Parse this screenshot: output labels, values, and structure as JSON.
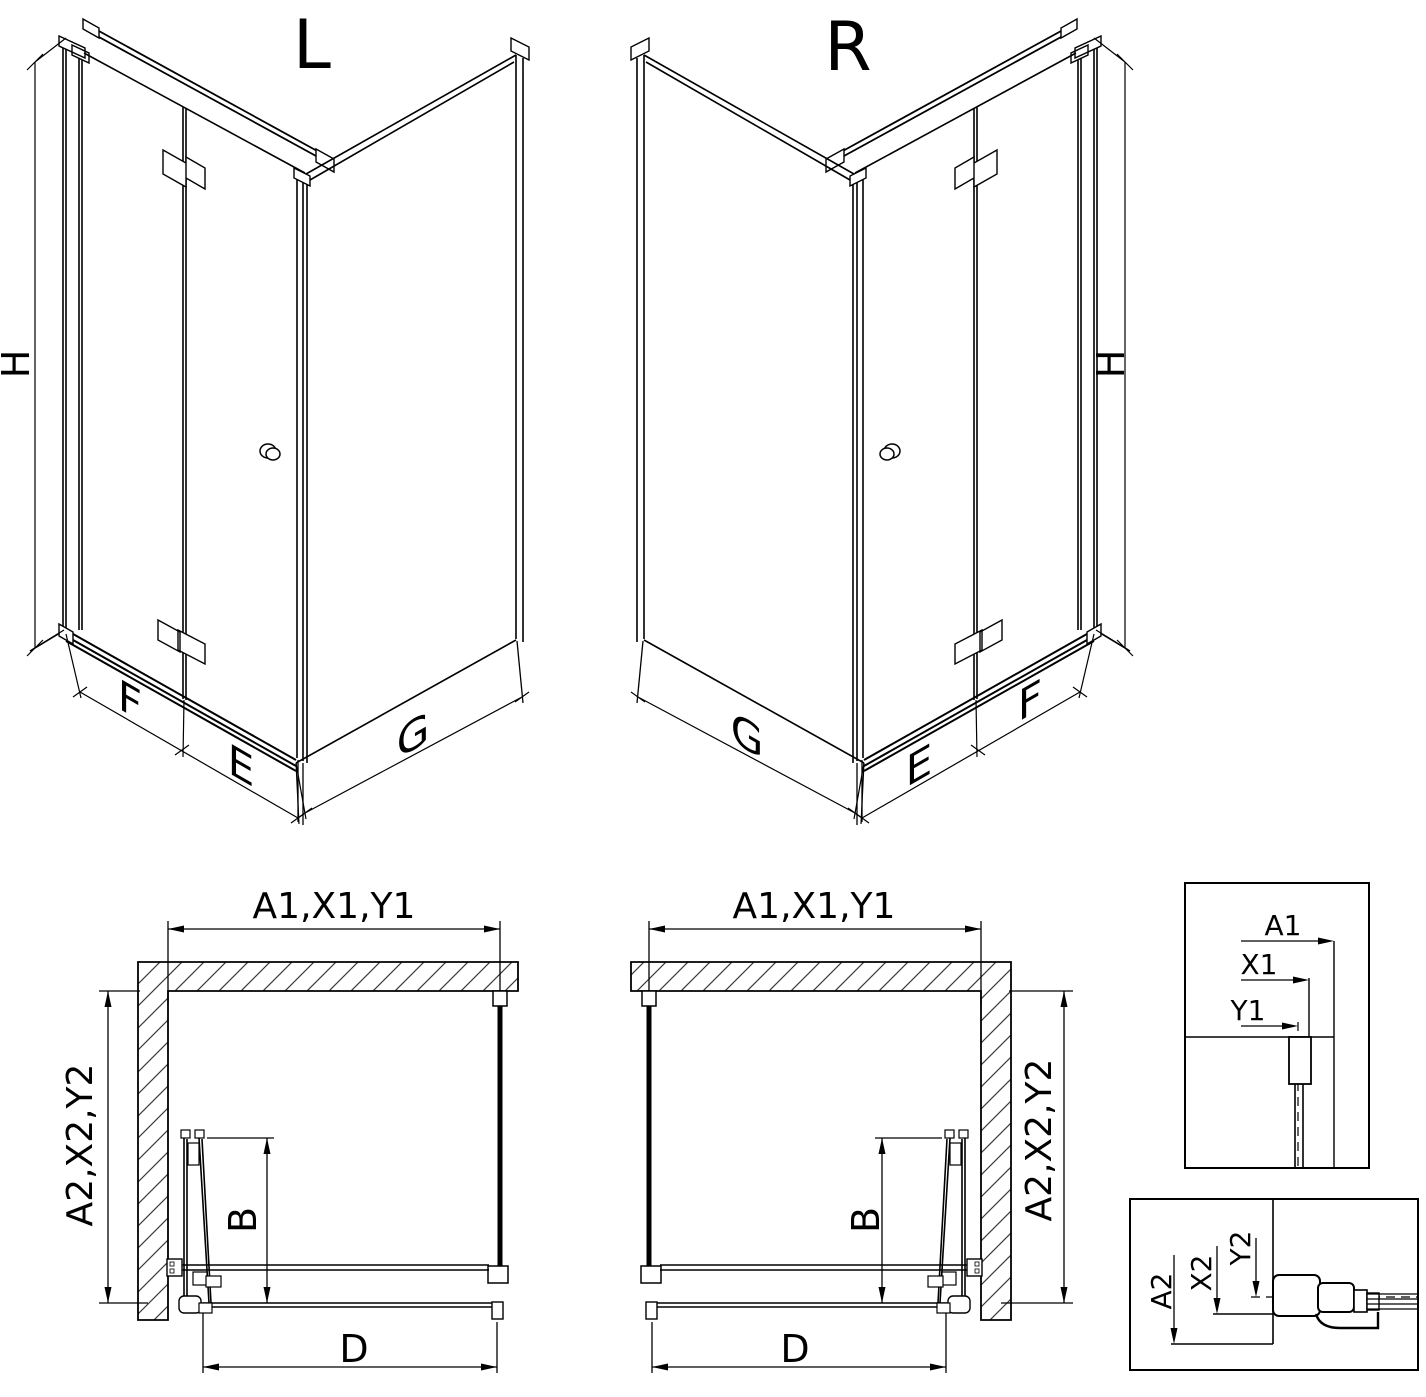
{
  "colors": {
    "background": "#ffffff",
    "line": "#000000",
    "hatch": "#3a3a3a"
  },
  "views": {
    "left_isometric": {
      "label": "L",
      "height_label": "H",
      "door_width_label": "F",
      "corner_width_label": "E",
      "side_wall_label": "G"
    },
    "right_isometric": {
      "label": "R",
      "height_label": "H",
      "door_width_label": "F",
      "corner_width_label": "E",
      "side_wall_label": "G"
    },
    "left_plan": {
      "width_dim_label": "A1,X1,Y1",
      "depth_dim_label": "A2,X2,Y2",
      "door_protrusion_label": "B",
      "entry_width_label": "D"
    },
    "right_plan": {
      "width_dim_label": "A1,X1,Y1",
      "depth_dim_label": "A2,X2,Y2",
      "door_protrusion_label": "B",
      "entry_width_label": "D"
    },
    "top_detail": {
      "dim_labels": [
        "A1",
        "X1",
        "Y1"
      ]
    },
    "bottom_detail": {
      "dim_labels": [
        "A2",
        "X2",
        "Y2"
      ]
    }
  }
}
